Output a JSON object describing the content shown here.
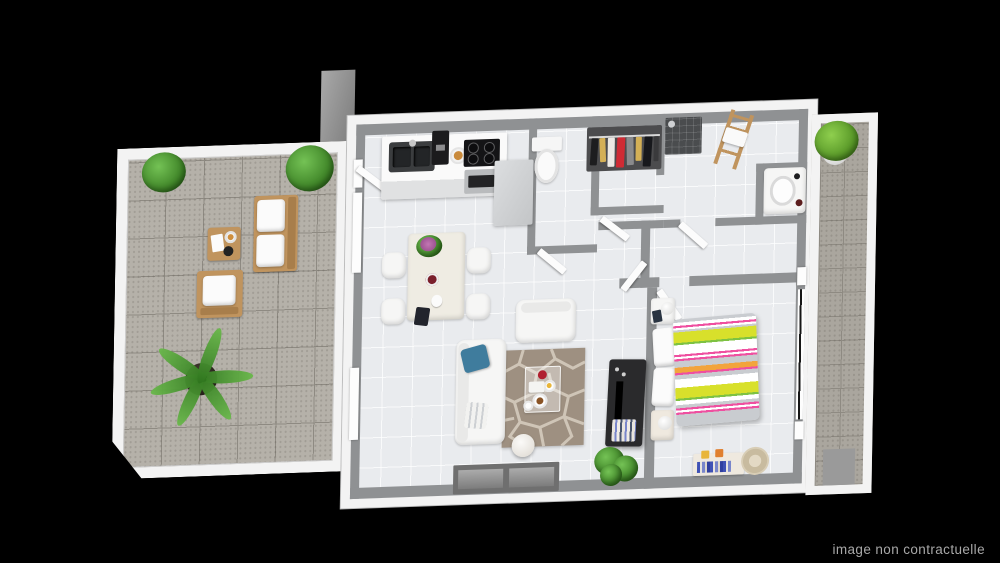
{
  "disclaimer": "image non contractuelle",
  "scene": "3d-apartment-floor-plan-top-view",
  "colors": {
    "background": "#000000",
    "outer_wall": "#f3f3f3",
    "inner_wall": "#8f9193",
    "interior_floor": "#e9ebee",
    "terrace_tile": "#b5b1a9",
    "terrace_grout": "#8e8a82",
    "wood": "#c0945e",
    "rug": "#9e9081",
    "rug_pattern": "#cfc5b7",
    "tv_unit": "#2a2a2c",
    "plant_green": "#4ea33c",
    "plant_green_dark": "#35791f",
    "pillow_blue": "#3f7c9d",
    "bed_yellow": "#d8e02b",
    "bed_pink": "#ef4fa0",
    "bed_orange": "#f2a43c",
    "bed_green": "#7dc242",
    "appliance_dark": "#1b1b1d",
    "disclaimer_text": "#a8a8a8"
  },
  "rooms": [
    "terrace",
    "kitchen",
    "wc",
    "dressing",
    "shower-room",
    "hallway",
    "living-dining",
    "bedroom",
    "balcony"
  ],
  "inventory": {
    "terrace": [
      "outdoor-sofa",
      "outdoor-armchair",
      "outdoor-coffee-table",
      "potted-plant",
      "potted-plant",
      "palm-plant"
    ],
    "kitchen": [
      "double-sink",
      "coffee-machine",
      "pastry-plate",
      "cooktop",
      "oven",
      "tall-cabinet"
    ],
    "wc": [
      "toilet"
    ],
    "dressing": [
      "clothes-rail-with-garments"
    ],
    "shower_room": [
      "shower",
      "towel-ladder",
      "washbasin"
    ],
    "living_dining": [
      "dining-table",
      "four-chairs",
      "flower-bouquet",
      "sofa",
      "blue-cushion",
      "armchair",
      "glass-coffee-table",
      "side-table",
      "stone-pattern-rug",
      "tv-cabinet",
      "potted-plant",
      "bay-window"
    ],
    "bedroom": [
      "striped-double-bed",
      "pillows",
      "nightstand-with-lamp",
      "nightstand-with-lamp",
      "bench-with-books",
      "round-rug"
    ],
    "balcony": [
      "potted-plant",
      "french-door"
    ]
  }
}
